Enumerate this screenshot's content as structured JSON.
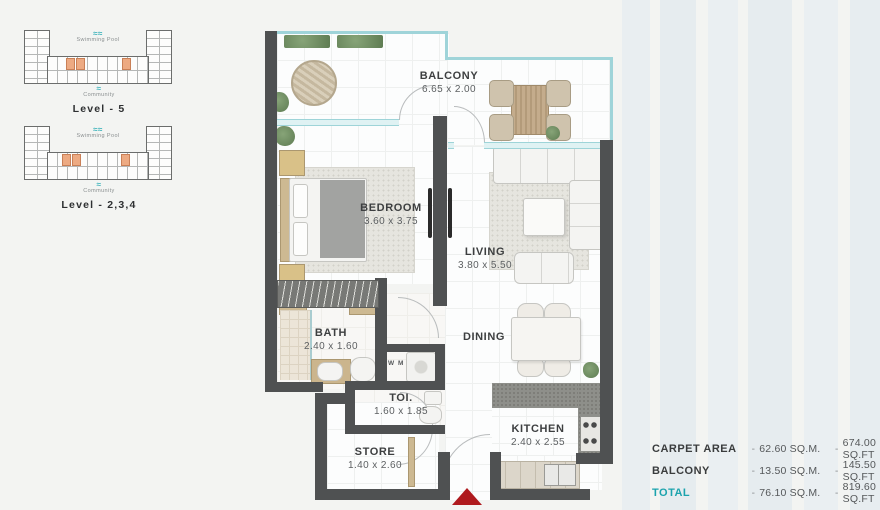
{
  "keyplans": [
    {
      "pool_label": "Swimming Pool",
      "community_label": "Community",
      "level_label": "Level - 5"
    },
    {
      "pool_label": "Swimming Pool",
      "community_label": "Community",
      "level_label": "Level - 2,3,4"
    }
  ],
  "icons": {
    "pool_glyph": "≈≈",
    "community_glyph": "≈"
  },
  "rooms": {
    "balcony": {
      "name": "BALCONY",
      "dims": "6.65 x 2.00"
    },
    "bedroom": {
      "name": "BEDROOM",
      "dims": "3.60 x 3.75"
    },
    "living": {
      "name": "LIVING",
      "dims": "3.80 x 5.50"
    },
    "bath": {
      "name": "BATH",
      "dims": "2.40 x 1.60"
    },
    "toilet": {
      "name": "TOI.",
      "dims": "1.60 x 1.85"
    },
    "store": {
      "name": "STORE",
      "dims": "1.40 x 2.60"
    },
    "dining": {
      "name": "DINING"
    },
    "kitchen": {
      "name": "KITCHEN",
      "dims": "2.40 x 2.55"
    },
    "wm": {
      "name": "W M"
    }
  },
  "area_table": {
    "separator": "-",
    "rows": [
      {
        "label": "CARPET AREA",
        "sqm": "62.60 SQ.M.",
        "sqft": "674.00 SQ.FT"
      },
      {
        "label": "BALCONY",
        "sqm": "13.50 SQ.M.",
        "sqft": "145.50 SQ.FT"
      },
      {
        "label": "TOTAL",
        "sqm": "76.10 SQ.M.",
        "sqft": "819.60 SQ.FT"
      }
    ]
  },
  "colors": {
    "accent_teal": "#1ba3ad",
    "wall": "#4f5152",
    "highlight_orange": "#edaa82",
    "entry_arrow_red": "#af1a1e",
    "glass_teal": "#9fd4d9"
  }
}
